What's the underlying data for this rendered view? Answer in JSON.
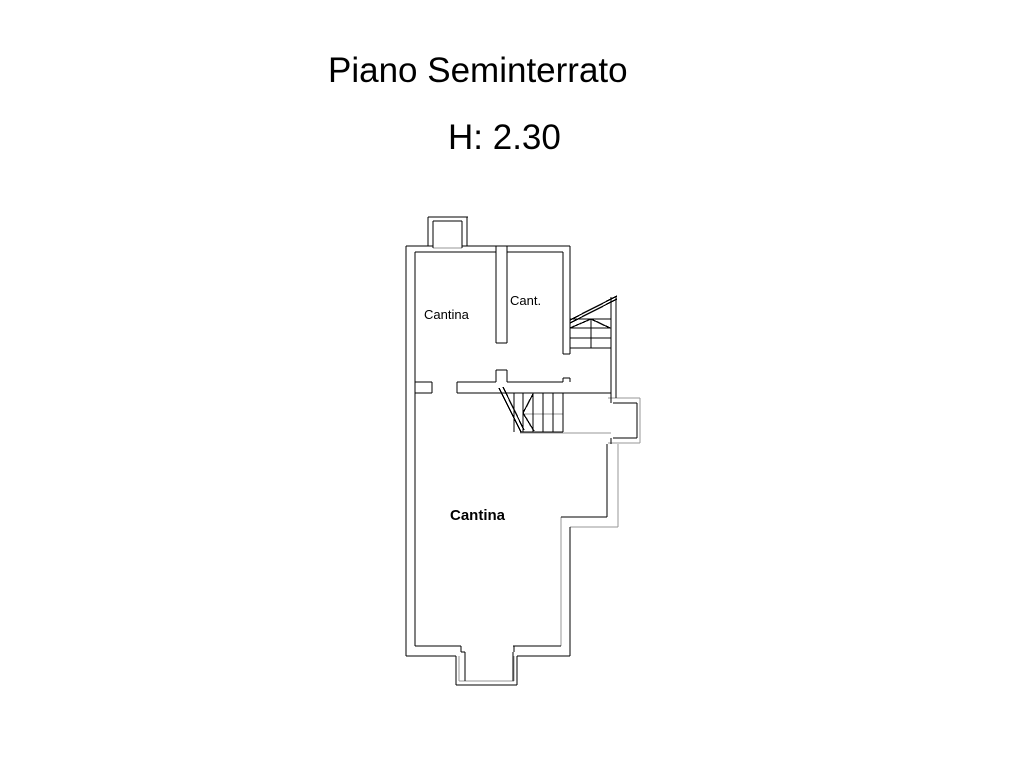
{
  "header": {
    "title": "Piano Seminterrato",
    "height_note": "H: 2.30"
  },
  "floorplan": {
    "colors": {
      "wall": "#000000",
      "light": "#979797",
      "background": "#ffffff"
    },
    "rooms": [
      {
        "label": "Cantina",
        "x": 424,
        "y": 308,
        "font_size": 13,
        "weight": 400
      },
      {
        "label": "Cant.",
        "x": 510,
        "y": 294,
        "font_size": 13,
        "weight": 400
      },
      {
        "label": "Cantina",
        "x": 450,
        "y": 508,
        "font_size": 15,
        "weight": 700
      }
    ],
    "wall_segments": [
      [
        406,
        246,
        406,
        656
      ],
      [
        415,
        252,
        415,
        646
      ],
      [
        406,
        246,
        433,
        246
      ],
      [
        462,
        246,
        570,
        246
      ],
      [
        415,
        252,
        496,
        252
      ],
      [
        507,
        252,
        563,
        252
      ],
      [
        428,
        217,
        468,
        217
      ],
      [
        428,
        217,
        428,
        246
      ],
      [
        467,
        217,
        467,
        246
      ],
      [
        433,
        221,
        462,
        221
      ],
      [
        433,
        221,
        433,
        248
      ],
      [
        462,
        221,
        462,
        248
      ],
      [
        496,
        246,
        496,
        343
      ],
      [
        507,
        246,
        507,
        343
      ],
      [
        496,
        343,
        507,
        343
      ],
      [
        496,
        370,
        496,
        382
      ],
      [
        507,
        370,
        507,
        382
      ],
      [
        496,
        370,
        507,
        370
      ],
      [
        563,
        252,
        563,
        354
      ],
      [
        570,
        246,
        570,
        354
      ],
      [
        563,
        354,
        570,
        354
      ],
      [
        563,
        378,
        563,
        382
      ],
      [
        570,
        378,
        570,
        382
      ],
      [
        563,
        378,
        570,
        378
      ],
      [
        415,
        382,
        432,
        382
      ],
      [
        432,
        382,
        432,
        393
      ],
      [
        415,
        393,
        432,
        393
      ],
      [
        457,
        382,
        496,
        382
      ],
      [
        457,
        382,
        457,
        393
      ],
      [
        507,
        382,
        563,
        382
      ],
      [
        457,
        393,
        611,
        393
      ],
      [
        514,
        393,
        514,
        432
      ],
      [
        523,
        393,
        523,
        432
      ],
      [
        533,
        393,
        533,
        432
      ],
      [
        543,
        393,
        543,
        432
      ],
      [
        553,
        393,
        553,
        432
      ],
      [
        563,
        393,
        563,
        432
      ],
      [
        520,
        432,
        563,
        432
      ],
      [
        499,
        388,
        521,
        432
      ],
      [
        503,
        387,
        524,
        430
      ],
      [
        533,
        394,
        523,
        413
      ],
      [
        523,
        413,
        534,
        431
      ],
      [
        570,
        319,
        611,
        319
      ],
      [
        570,
        328,
        611,
        328
      ],
      [
        570,
        338,
        611,
        338
      ],
      [
        570,
        348,
        611,
        348
      ],
      [
        591,
        319,
        591,
        348
      ],
      [
        611,
        297,
        611,
        403
      ],
      [
        616,
        297,
        616,
        398
      ],
      [
        570,
        320,
        617,
        296
      ],
      [
        570,
        323,
        617,
        299
      ],
      [
        570,
        328,
        591,
        319
      ],
      [
        591,
        319,
        610,
        328
      ],
      [
        613,
        403,
        637,
        403
      ],
      [
        637,
        403,
        637,
        438
      ],
      [
        613,
        438,
        637,
        438
      ],
      [
        611,
        438,
        611,
        444
      ],
      [
        607,
        444,
        607,
        517
      ],
      [
        561,
        517,
        607,
        517
      ],
      [
        570,
        527,
        570,
        656
      ],
      [
        415,
        646,
        461,
        646
      ],
      [
        513,
        646,
        561,
        646
      ],
      [
        406,
        656,
        456,
        656
      ],
      [
        517,
        656,
        570,
        656
      ],
      [
        456,
        656,
        456,
        685
      ],
      [
        517,
        656,
        517,
        685
      ],
      [
        456,
        685,
        517,
        685
      ],
      [
        461,
        646,
        461,
        652
      ],
      [
        461,
        652,
        465,
        652
      ],
      [
        514,
        646,
        514,
        652
      ],
      [
        465,
        652,
        465,
        681
      ],
      [
        513,
        652,
        513,
        681
      ]
    ],
    "light_segments": [
      [
        433,
        248,
        462,
        248
      ],
      [
        523,
        414,
        563,
        414
      ],
      [
        520,
        433,
        611,
        433
      ],
      [
        608,
        398,
        640,
        398
      ],
      [
        640,
        398,
        640,
        443
      ],
      [
        608,
        443,
        640,
        443
      ],
      [
        618,
        444,
        618,
        527
      ],
      [
        570,
        527,
        618,
        527
      ],
      [
        561,
        517,
        561,
        646
      ],
      [
        459,
        656,
        459,
        681
      ],
      [
        514,
        656,
        514,
        681
      ],
      [
        459,
        681,
        514,
        681
      ]
    ]
  }
}
